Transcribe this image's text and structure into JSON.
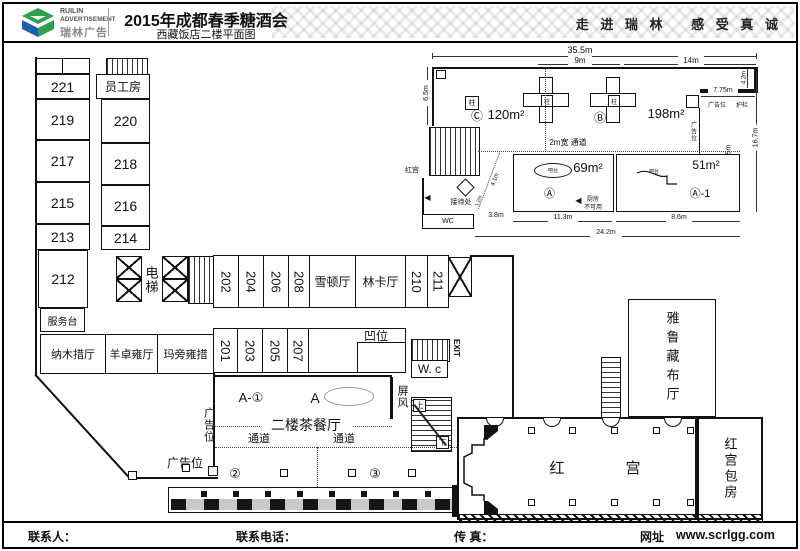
{
  "header": {
    "logo_line1": "RUILIN",
    "logo_line2": "ADVERTISEMENT",
    "logo_line3": "瑞林广告",
    "title": "2015年成都春季糖酒会",
    "subtitle": "西藏饭店二楼平面图",
    "slogan": "走 进 瑞 林　 感 受 真 诚"
  },
  "footer": {
    "contact": "联系人：",
    "phone": "联系电话：",
    "fax": "传 真：",
    "web_label": "网址",
    "website": "www.scrlgg.com"
  },
  "plan": {
    "left_rooms": [
      "221",
      "219",
      "217",
      "215",
      "213",
      "212"
    ],
    "service_desk": "服务台",
    "staff_room": "员工房",
    "col2_rooms": [
      "220",
      "218",
      "216",
      "214"
    ],
    "elevator": "电梯",
    "halls": [
      "纳木措厅",
      "羊卓雍厅",
      "玛旁雍措"
    ],
    "top_booths": [
      "202",
      "204",
      "206",
      "208"
    ],
    "xuedun": "雪顿厅",
    "linka": "林卡厅",
    "right_booths": [
      "210",
      "211"
    ],
    "bottom_booths": [
      "201",
      "203",
      "205",
      "207"
    ],
    "recess": "凹位",
    "wc": "W. c",
    "exit": "EXIT",
    "screen": "屏风",
    "zone_a1": "A-①",
    "zone_a": "A",
    "tea_room": "二楼茶餐厅",
    "passage": "通道",
    "ad_side": "广告位",
    "ad_bottom": "广告位",
    "marker2": "②",
    "marker3": "③",
    "stairs_up": "上",
    "stairs_down": "下",
    "yarlung": "雅鲁藏布厅",
    "red1": "红",
    "red2": "宫",
    "red_room": "红宫包房"
  },
  "upper": {
    "dim_total": "35.5m",
    "dim_9": "9m",
    "dim_14": "14m",
    "dim_65": "6.5m",
    "dim_42": "4.2m",
    "dim_775": "7.75m",
    "dim_125": "12.5m",
    "dim_167": "16.7m",
    "dim_113": "11.3m",
    "dim_86": "8.6m",
    "dim_242": "24.2m",
    "dim_38": "3.8m",
    "dim_41": "4.1m",
    "dim_12": "1.2m",
    "zone_c_mark": "Ⓒ",
    "zone_c_area": "120m²",
    "zone_b_mark": "Ⓑ",
    "zone_b_area": "198m²",
    "column": "柱",
    "passage_2m": "2m宽 通道",
    "ad_pos": "广告位",
    "rail": "护栏",
    "zone_a_area": "69m²",
    "bar": "吧台",
    "zone_a_mark": "Ⓐ",
    "zone_a1_area": "51m²",
    "zone_a1_mark": "Ⓐ-1",
    "kitchen_note1": "厨房",
    "kitchen_note2": "不可用",
    "reception": "接待处",
    "wc": "WC",
    "red_dir": "红宫",
    "arrow_left": "◀"
  }
}
